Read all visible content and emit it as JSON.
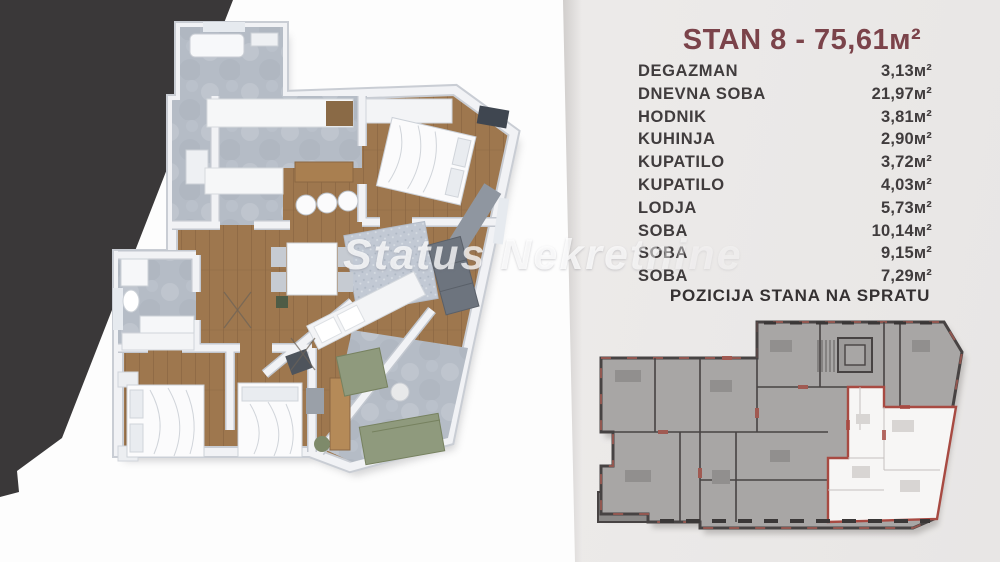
{
  "watermark": "Status Nekretnine",
  "panel": {
    "title": "STAN 8 - 75,61м²",
    "section_heading": "POZICIJA STANA NA SPRATU",
    "rooms": [
      {
        "label": "DEGAZMAN",
        "area": "3,13м²"
      },
      {
        "label": "DNEVNA SOBA",
        "area": "21,97м²"
      },
      {
        "label": "HODNIK",
        "area": "3,81м²"
      },
      {
        "label": "KUHINJA",
        "area": "2,90м²"
      },
      {
        "label": "KUPATILO",
        "area": "3,72м²"
      },
      {
        "label": "KUPATILO",
        "area": "4,03м²"
      },
      {
        "label": "LODJA",
        "area": "5,73м²"
      },
      {
        "label": "SOBA",
        "area": "10,14м²"
      },
      {
        "label": "SOBA",
        "area": "9,15м²"
      },
      {
        "label": "SOBA",
        "area": "7,29м²"
      }
    ]
  },
  "colors": {
    "title_maroon": "#7b434a",
    "text_dark": "#403c3d",
    "panel_bg": "#ebe9e8",
    "dark_wedge": "#3a3839",
    "wood_floor": "#9e774e",
    "marble_floor": "#b5bcc6",
    "wall_white": "#f2f3f6",
    "miniplan_gray": "#a8a6a5",
    "miniplan_wall": "#474343",
    "miniplan_red": "#a05a52",
    "highlight_apartment": "#f7f6f5",
    "lodja_green": "#8f9a7d"
  }
}
